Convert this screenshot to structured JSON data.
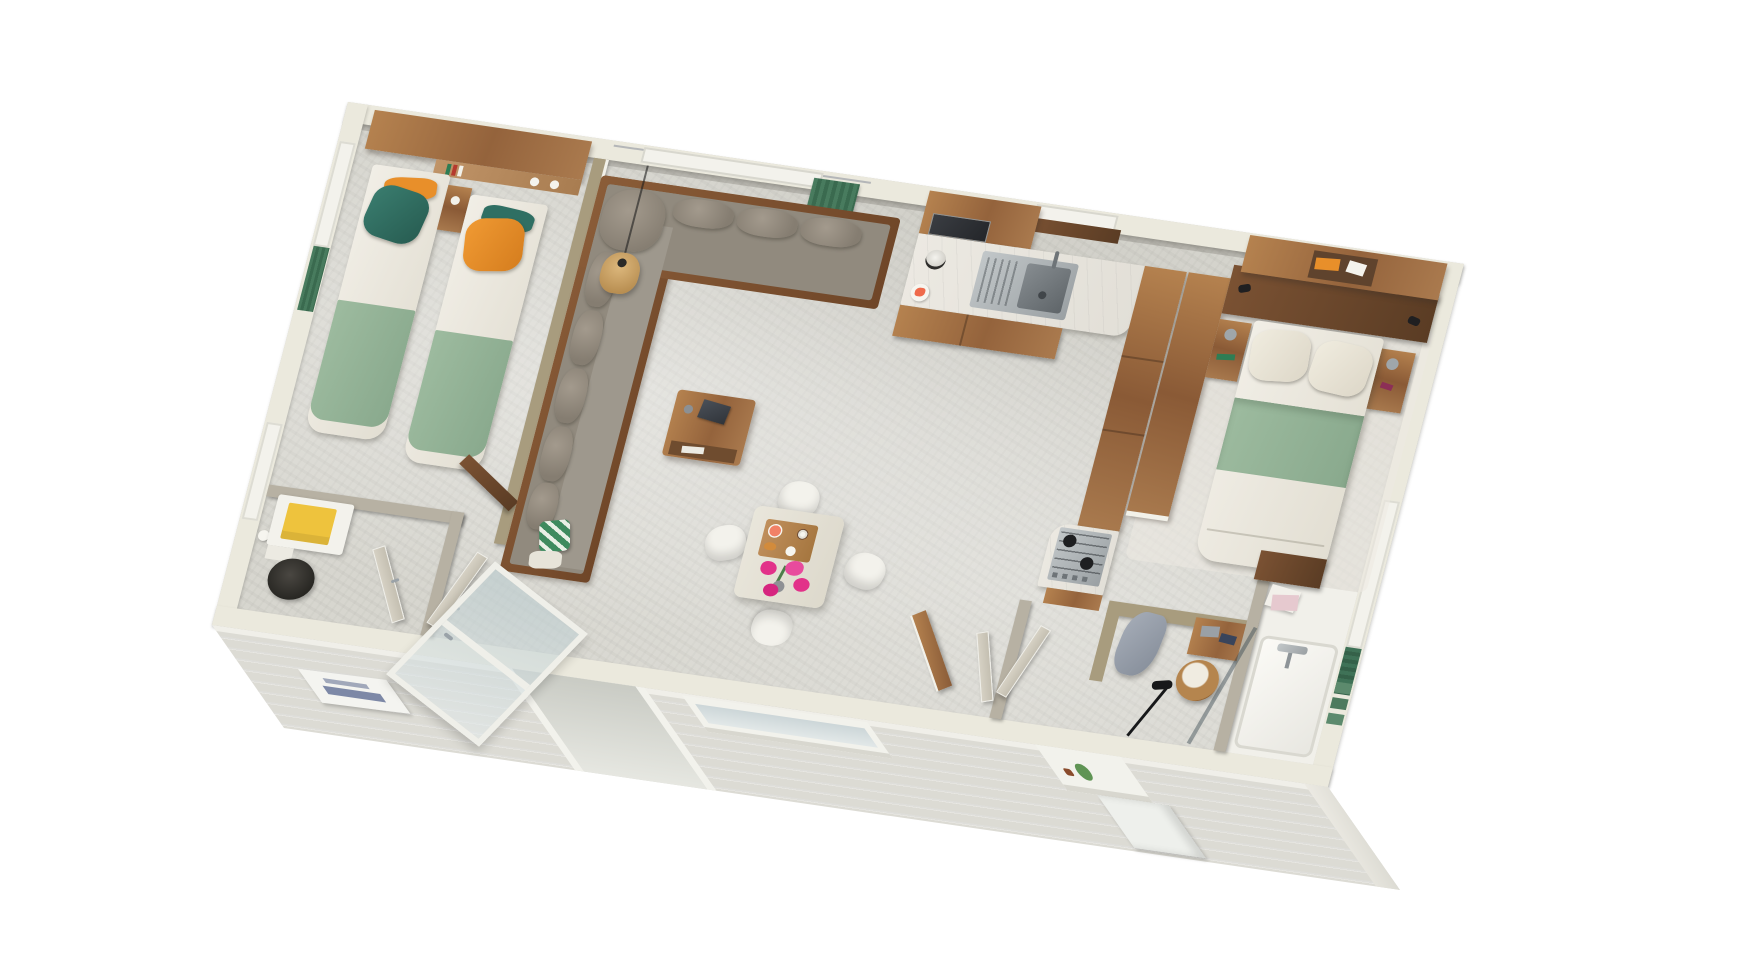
{
  "palette": {
    "floor": "#d7d6cf",
    "wallTop": "#ebe9dd",
    "wallFace": "#b7b1a3",
    "wallKhaki": "#a89c7e",
    "siding": "#dcdbd4",
    "sofa": "#918a7e",
    "sage": "#95b49a",
    "teal": "#2f6f63",
    "orange": "#e88f2a",
    "sheet": "#efece3",
    "pink": "#e23189",
    "grapefruit": "#ef6a4b",
    "yellow": "#eec33d",
    "towelGreen": "#5c8a6d",
    "rattan": "#b5854e"
  },
  "scene": {
    "type": "isometric-3d-floorplan",
    "subject": "mobile-home interior cutaway render, white background",
    "rooms": [
      {
        "name": "twin-bedroom",
        "furniture": [
          "single-bed",
          "single-bed",
          "nightstand",
          "overhead-cabinet",
          "wall-shelf",
          "window-green-curtain"
        ]
      },
      {
        "name": "wc-bathroom",
        "furniture": [
          "vanity-with-yellow-towel",
          "toilet",
          "toilet-paper",
          "window"
        ]
      },
      {
        "name": "living-room",
        "furniture": [
          "corner-sofa",
          "coffee-table",
          "laptop",
          "rattan-pendant-lamp",
          "green-plaid-pillow",
          "window-green-curtain"
        ]
      },
      {
        "name": "kitchen",
        "furniture": [
          "upper-cabinets",
          "microwave",
          "sink",
          "faucet",
          "coffee-machine",
          "plate-of-food",
          "tall-cabinets",
          "gas-hob"
        ]
      },
      {
        "name": "dining-area",
        "furniture": [
          "square-table",
          "chair",
          "chair",
          "chair",
          "chair",
          "breakfast-tray",
          "pink-flower-bouquet"
        ]
      },
      {
        "name": "master-bedroom",
        "furniture": [
          "double-bed",
          "nightstand",
          "nightstand",
          "overhead-cabinet",
          "headboard-panel",
          "wardrobe-column",
          "reading-spotlights"
        ]
      },
      {
        "name": "dressing-area",
        "furniture": [
          "hanging-bathrobe",
          "wall-shelf-towels",
          "rattan-basket",
          "arc-floor-lamp"
        ]
      },
      {
        "name": "shower-room",
        "furniture": [
          "shower-tray",
          "glass-panel",
          "towel-stack",
          "green-towels",
          "walnut-partition"
        ]
      }
    ],
    "exterior": [
      "white-horizontal-siding-front-wall",
      "brand-plate",
      "open-glazed-door",
      "window-planter",
      "entry-step"
    ]
  }
}
